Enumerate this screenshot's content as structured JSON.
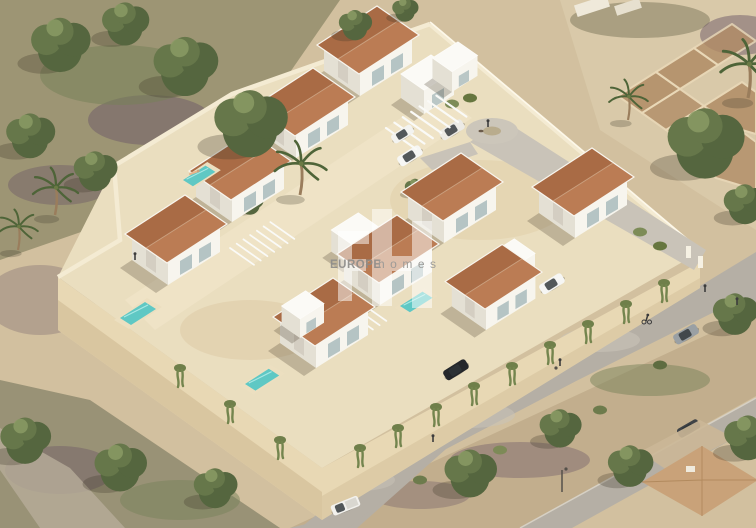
{
  "watermark": {
    "logo_monogram": "EH",
    "brand_name": "EUROPE",
    "brand_suffix": "homes"
  },
  "palette": {
    "sand": "#d2c09f",
    "sandLight": "#e2d2b1",
    "terrace": "#eadebf",
    "wallTop": "#f4ebd3",
    "wallFace": "#e8d8b4",
    "wallFaceShade": "#d9c6a0",
    "road": "#b5afa5",
    "roadLight": "#c9c3b8",
    "roof": "#bb7c54",
    "roofDark": "#a96b45",
    "white": "#f7f5ee",
    "whiteShade": "#e4e0d4",
    "whiteTop": "#fbfaf6",
    "pool": "#5fc8c4",
    "poolDeck": "#ecdfc0",
    "greenDark": "#55663f",
    "greenMid": "#66774a",
    "greenLight": "#8a9a64",
    "hedge": "#71814c",
    "purpleScrub": "#6e5a68",
    "ruin": "#b18c66",
    "ruinLine": "#ead9b8",
    "neighborRoof": "#c9a279",
    "watermarkBlock": "#ffffff",
    "watermarkText": "#8e8d8a",
    "watermarkTextLight": "#9a9996"
  },
  "scene": {
    "setting": "aerial isometric 3D render of a gated villa development on a hillside plot",
    "villas_visible": 10,
    "pools_visible": 5,
    "pergolas_visible": 3,
    "vehicles": [
      "white-suv-on-road",
      "black-sedan-on-road",
      "grey-hatchback-on-road",
      "white-pickup-truck",
      "white-parked-car-carport-1",
      "white-parked-car-carport-2",
      "white-parked-car-driveway",
      "dark-parked-car-neighbor",
      "grey-parked-car-neighbor"
    ],
    "people": [
      "dog-walker-at-turnaround",
      "pedestrian-with-stroller",
      "pedestrian-on-road",
      "cyclist",
      "sunbather-on-pool-1",
      "sunbather-on-pool-2",
      "pedestrians-near-gate"
    ],
    "landscape": [
      "mediterranean-tree-cluster",
      "palm-trees",
      "stone-ruins-plot",
      "perimeter-retaining-wall-with-vines",
      "hedge-median",
      "scrubland",
      "neighboring-house"
    ]
  }
}
